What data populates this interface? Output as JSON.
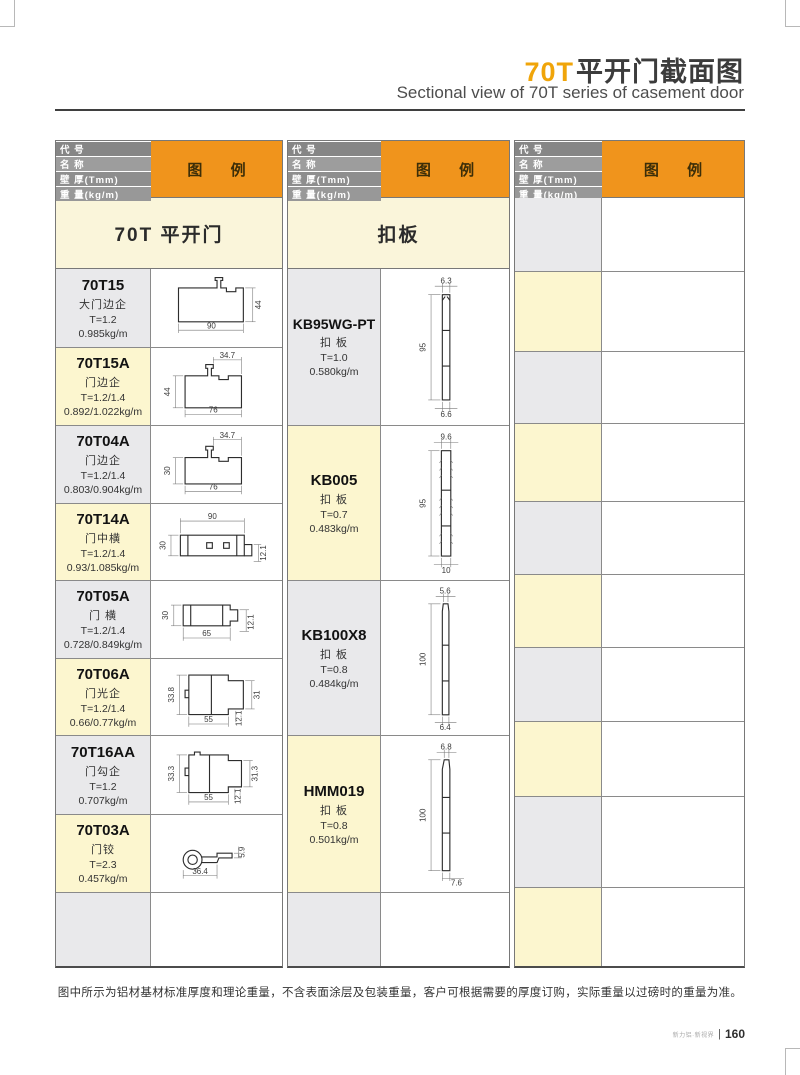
{
  "page": {
    "title_accent": "70T",
    "title_cn": "平开门截面图",
    "subtitle": "Sectional  view of 70T series of casement door",
    "note": "图中所示为铝材基材标准厚度和理论重量，不含表面涂层及包装重量，客户可根据需要的厚度订购，实际重量以过磅时的重量为准。",
    "footer_brand": "新力铝·新视界",
    "footer_page": "160"
  },
  "header_block": {
    "r1": "代 号",
    "r2": "名 称",
    "r3": "壁 厚(Tmm)",
    "r4": "重 量(kg/m)",
    "legend": "图 例"
  },
  "groups": [
    {
      "section": "70T 平开门",
      "rows": [
        {
          "code": "70T15",
          "name": "大门边企",
          "t": "T=1.2",
          "w": "0.985kg/m",
          "d_bottom": "90",
          "d_right": "44"
        },
        {
          "code": "70T15A",
          "name": "门边企",
          "t": "T=1.2/1.4",
          "w": "0.892/1.022kg/m",
          "d_top": "34.7",
          "d_left": "44",
          "d_bottom": "76"
        },
        {
          "code": "70T04A",
          "name": "门边企",
          "t": "T=1.2/1.4",
          "w": "0.803/0.904kg/m",
          "d_top": "34.7",
          "d_left": "30",
          "d_bottom": "76"
        },
        {
          "code": "70T14A",
          "name": "门中横",
          "t": "T=1.2/1.4",
          "w": "0.93/1.085kg/m",
          "d_top": "90",
          "d_left": "30",
          "d_right": "12.1"
        },
        {
          "code": "70T05A",
          "name": "门 横",
          "t": "T=1.2/1.4",
          "w": "0.728/0.849kg/m",
          "d_left": "30",
          "d_bottom": "65",
          "d_right": "12.1"
        },
        {
          "code": "70T06A",
          "name": "门光企",
          "t": "T=1.2/1.4",
          "w": "0.66/0.77kg/m",
          "d_left": "33.8",
          "d_right": "31",
          "d_bottom": "55",
          "d_extra": "12.1"
        },
        {
          "code": "70T16AA",
          "name": "门勾企",
          "t": "T=1.2",
          "w": "0.707kg/m",
          "d_left": "33.3",
          "d_right": "31.3",
          "d_bottom": "55",
          "d_extra": "12.1"
        },
        {
          "code": "70T03A",
          "name": "门铰",
          "t": "T=2.3",
          "w": "0.457kg/m",
          "d_top": "5.9",
          "d_bottom": "36.4"
        }
      ]
    },
    {
      "section": "扣板",
      "rows": [
        {
          "code": "KB95WG-PT",
          "name": "扣 板",
          "t": "T=1.0",
          "w": "0.580kg/m",
          "d_top": "6.3",
          "d_left": "95",
          "d_bottom": "6.6"
        },
        {
          "code": "KB005",
          "name": "扣 板",
          "t": "T=0.7",
          "w": "0.483kg/m",
          "d_top": "9.6",
          "d_left": "95",
          "d_bottom": "10"
        },
        {
          "code": "KB100X8",
          "name": "扣 板",
          "t": "T=0.8",
          "w": "0.484kg/m",
          "d_top": "5.6",
          "d_left": "100",
          "d_bottom": "6.4"
        },
        {
          "code": "HMM019",
          "name": "扣 板",
          "t": "T=0.8",
          "w": "0.501kg/m",
          "d_top": "6.8",
          "d_left": "100",
          "d_bottom": "7.6"
        }
      ]
    },
    {
      "section": "",
      "rows": []
    }
  ],
  "colors": {
    "accent_orange": "#F0941C",
    "title_orange": "#F0A50A",
    "header_gray": "#8E8E8E",
    "section_cream": "#FAF5DA",
    "cell_cream": "#FCF6CF",
    "cell_gray": "#E9E9EB",
    "border": "#787878"
  }
}
